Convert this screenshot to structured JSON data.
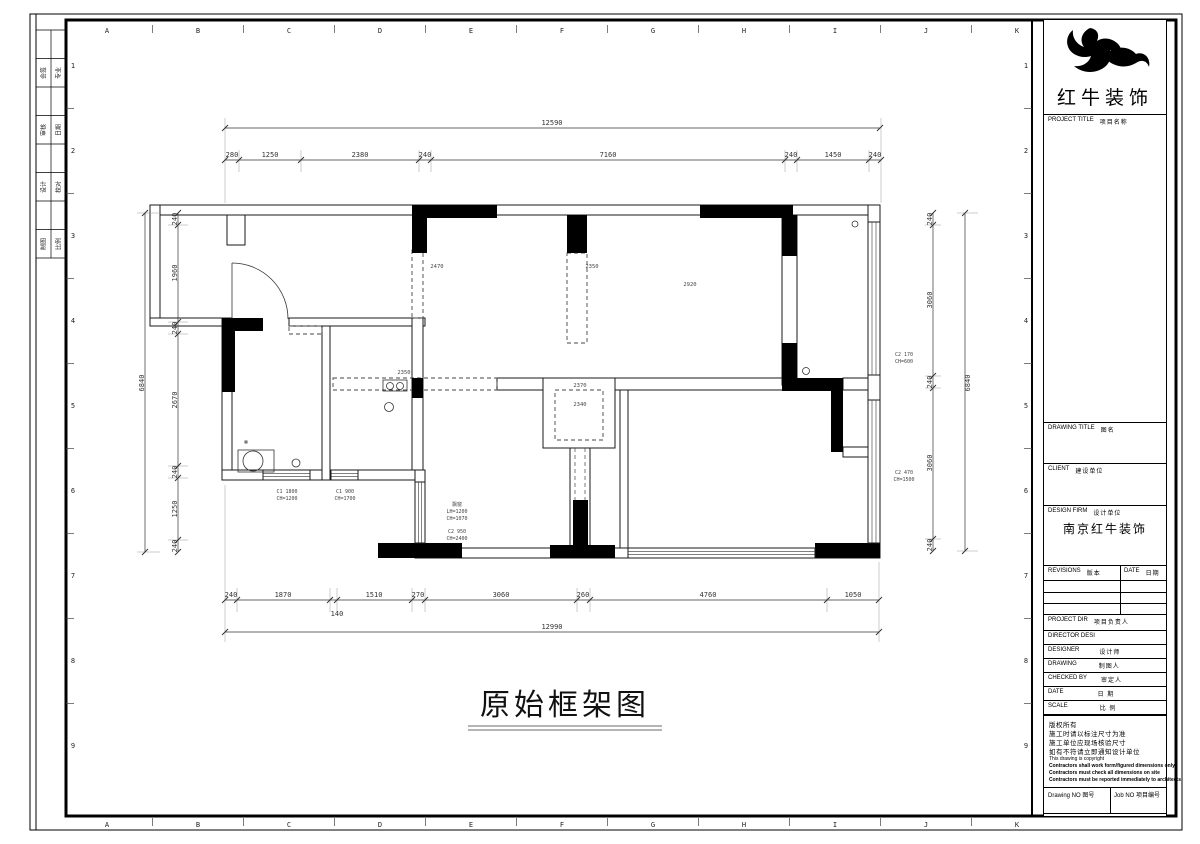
{
  "sheet": {
    "grid_letters": [
      "A",
      "B",
      "C",
      "D",
      "E",
      "F",
      "G",
      "H",
      "I",
      "J",
      "K"
    ],
    "grid_numbers": [
      "1",
      "2",
      "3",
      "4",
      "5",
      "6",
      "7",
      "8",
      "9"
    ],
    "signature_cells": [
      {
        "left": "会签",
        "right": "专业"
      },
      {
        "left": "审核",
        "right": "日期"
      },
      {
        "left": "设计",
        "right": "校对"
      },
      {
        "left": "制图",
        "right": "比例"
      }
    ]
  },
  "title_block": {
    "company": "红牛装饰",
    "project_title_en": "PROJECT TITLE",
    "project_title_cn": "项目名称",
    "drawing_title_en": "DRAWING TITLE",
    "drawing_title_cn": "图名",
    "client_en": "CLIENT",
    "client_cn": "建设单位",
    "design_firm_en": "DESIGN FIRM",
    "design_firm_cn": "设计单位",
    "design_firm_value": "南京红牛装饰",
    "revisions_en": "REVISIONS",
    "revisions_cn": "版本",
    "rev_date_en": "DATE",
    "rev_date_cn": "日期",
    "project_dir_en": "PROJECT DIR",
    "project_dir_cn": "项目负责人",
    "director_en": "DIRECTOR DESI",
    "director_cn": "",
    "designer_en": "DESIGNER",
    "designer_cn": "设计师",
    "drawing_en": "DRAWING",
    "drawing_cn": "制图人",
    "checked_en": "CHECKED BY",
    "checked_cn": "审定人",
    "date_en": "DATE",
    "date_cn": "日 期",
    "scale_en": "SCALE",
    "scale_cn": "比 例",
    "notes_cn": [
      "版权所有",
      "施工时请以标注尺寸为准",
      "施工单位应现场核验尺寸",
      "如有不符请立即通知设计单位"
    ],
    "notes_en": [
      "This drawing is copyright",
      "Contractors shall work form/figured dimensions only",
      "Contractors must check all dimensions on site",
      "Contractors must be reported immediately to architects"
    ],
    "drawing_no_en": "Drawing NO",
    "drawing_no_cn": "图号",
    "job_no_en": "Job NO",
    "job_no_cn": "项目编号"
  },
  "plan": {
    "title": "原始框架图",
    "dims": {
      "top_total": "12590",
      "top": [
        "280",
        "1250",
        "2380",
        "240",
        "7160",
        "240",
        "1450",
        "240"
      ],
      "bottom": [
        "240",
        "1870",
        "140",
        "1510",
        "270",
        "3060",
        "260",
        "4760",
        "1050"
      ],
      "bottom_total": "12990",
      "left_total": "6840",
      "left": [
        "240",
        "1960",
        "240",
        "2670",
        "240",
        "1250",
        "240"
      ],
      "right": [
        "240",
        "3060",
        "240",
        "3060",
        "240"
      ],
      "right_total": "6840"
    },
    "beam_labels": [
      "2470",
      "2350",
      "2920",
      "2350",
      "2370",
      "2340"
    ],
    "window_labels": {
      "wl1": [
        "C1 1800",
        "CH=1200"
      ],
      "wl2": [
        "C1 900",
        "CH=1700"
      ],
      "wl3": [
        "飘窗",
        "LH=1200",
        "CH=1070"
      ],
      "wl4": [
        "C2 950",
        "CH=2400"
      ],
      "wr1": [
        "C2 170",
        "CH=600"
      ],
      "wr2": [
        "C2 470",
        "CH=1500"
      ]
    }
  }
}
